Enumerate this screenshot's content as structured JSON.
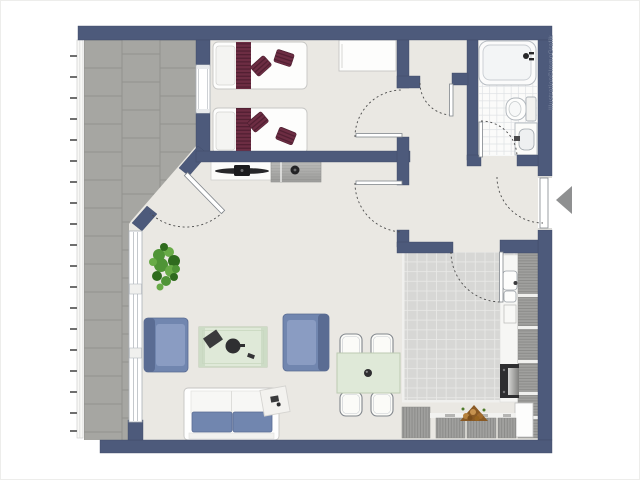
{
  "watermark": {
    "text": "Illustration©ImmoGrafik"
  },
  "palette": {
    "wall": "#4d5a7b",
    "floor": "#eae8e3",
    "terraceTile": "#a6a6a2",
    "terraceJoint": "#92928e",
    "kitchenTile": "#d7d7d5",
    "kitchenGrout": "#e8e8e6",
    "bathTile": "#fbfbfa",
    "bathGrout": "#dfe2e5",
    "blue": "#7186af",
    "blueDark": "#5a6c93",
    "blueLight": "#8a9cc2",
    "maroon": "#6d2d43",
    "maroonDark": "#521f32",
    "tableGreen": "#dfe9d8",
    "tableGreenBorder": "#bccab2",
    "plantGreen": "#4f9436",
    "plantLight": "#68ab47",
    "plantDark": "#2f6b1e",
    "counterGray": "#a0a09e",
    "counterLine": "#8a8a88",
    "arrowGray": "#8f9091",
    "wm": "#7d88a0",
    "dash": "#4a4a4a",
    "outline": "#c6c6c4"
  },
  "symbols": [
    "terrace",
    "bedroom",
    "bathroom",
    "hallway",
    "living-room",
    "kitchen",
    "single-bed",
    "wardrobe",
    "tv-sideboard",
    "bathtub",
    "toilet",
    "washbasin",
    "kitchen-sink",
    "stove",
    "fridge",
    "kitchen-counter",
    "firewood",
    "dining-table",
    "dining-chair",
    "coffee-table",
    "armchair",
    "sofa",
    "side-table",
    "plant",
    "entrance-arrow",
    "door-swing",
    "window",
    "railing"
  ]
}
